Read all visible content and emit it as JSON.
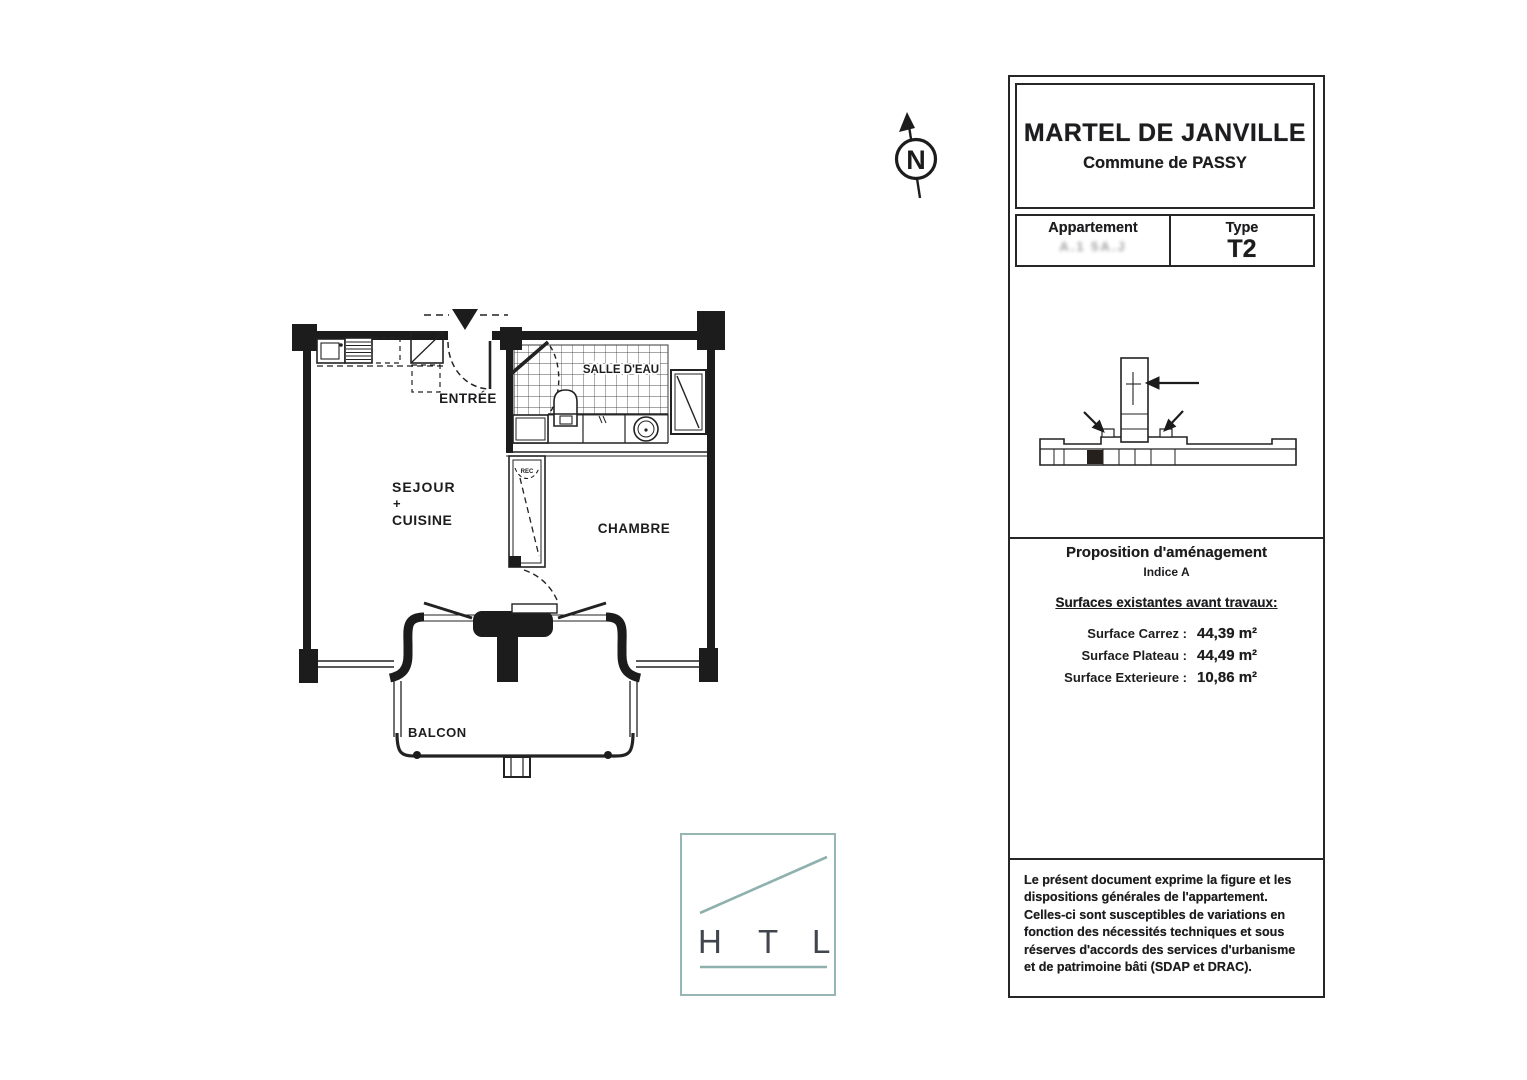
{
  "title_block": {
    "project": "MARTEL DE JANVILLE",
    "commune": "Commune de PASSY",
    "apartment_label": "Appartement",
    "apartment_number": "A.1 5A.J",
    "type_label": "Type",
    "type_value": "T2"
  },
  "proposition": {
    "heading": "Proposition d'aménagement",
    "indice": "Indice A",
    "surfaces_heading": "Surfaces existantes avant travaux:",
    "surfaces": [
      {
        "label": "Surface Carrez :",
        "value": "44,39 m²"
      },
      {
        "label": "Surface Plateau :",
        "value": "44,49 m²"
      },
      {
        "label": "Surface Exterieure :",
        "value": "10,86 m²"
      }
    ]
  },
  "legal": {
    "text": "Le présent document exprime la figure et les dispositions générales de l'appartement. Celles-ci sont susceptibles de variations en fonction des nécessités techniques et sous réserves d'accords des services d'urbanisme et de patrimoine bâti (SDAP et DRAC)."
  },
  "floor_plan": {
    "rooms": {
      "entree": "ENTRÉE",
      "salle_deau": "SALLE D'EAU",
      "sejour_line1": "SEJOUR",
      "sejour_line2": "+",
      "sejour_line3": "CUISINE",
      "chambre": "CHAMBRE",
      "balcon": "BALCON",
      "closet": "REC"
    }
  },
  "compass": {
    "letter": "N"
  },
  "logo": {
    "letters": [
      "H",
      "T",
      "L"
    ],
    "accent_color": "#8fb1ae",
    "text_color": "#41454e"
  },
  "colors": {
    "ink": "#1d1d1f",
    "wall": "#1c1c1c",
    "marker_cell": "#26201c"
  }
}
